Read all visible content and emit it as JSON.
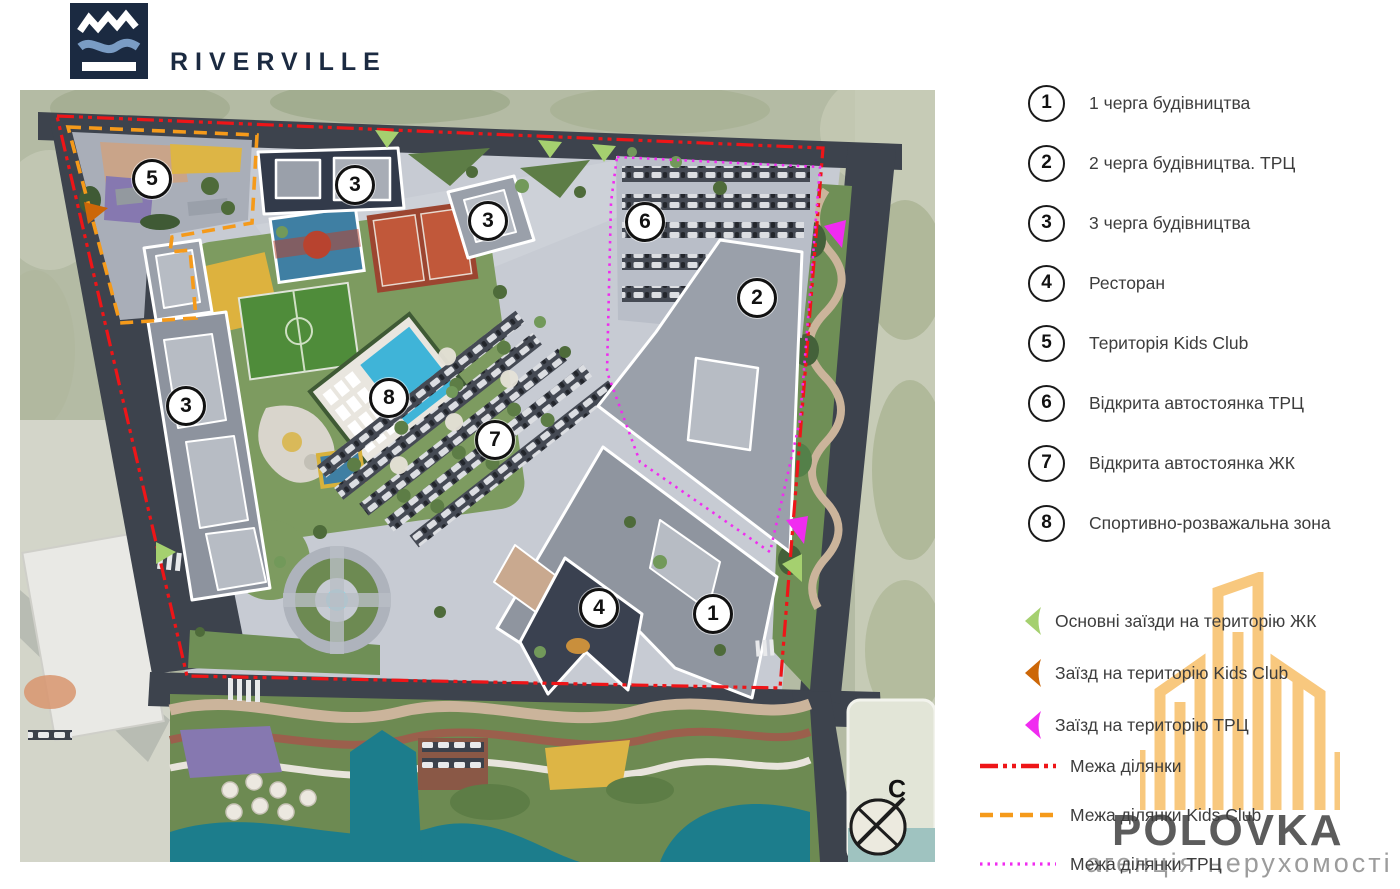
{
  "brand": {
    "name": "RIVERVILLE"
  },
  "map": {
    "compass_label": "С",
    "badges": [
      {
        "label": "5",
        "x": 132,
        "y": 89
      },
      {
        "label": "3",
        "x": 335,
        "y": 95
      },
      {
        "label": "3",
        "x": 468,
        "y": 131
      },
      {
        "label": "6",
        "x": 625,
        "y": 132
      },
      {
        "label": "2",
        "x": 737,
        "y": 208
      },
      {
        "label": "8",
        "x": 369,
        "y": 308
      },
      {
        "label": "3",
        "x": 166,
        "y": 316
      },
      {
        "label": "7",
        "x": 475,
        "y": 350
      },
      {
        "label": "4",
        "x": 579,
        "y": 518
      },
      {
        "label": "1",
        "x": 693,
        "y": 524
      }
    ]
  },
  "legend": {
    "items": [
      {
        "num": "1",
        "label": "1 черга будівництва"
      },
      {
        "num": "2",
        "label": "2 черга будівництва. ТРЦ"
      },
      {
        "num": "3",
        "label": "3 черга будівництва"
      },
      {
        "num": "4",
        "label": "Ресторан"
      },
      {
        "num": "5",
        "label": "Територія Kids Club"
      },
      {
        "num": "6",
        "label": "Відкрита автостоянка ТРЦ"
      },
      {
        "num": "7",
        "label": "Відкрита автостоянка ЖК"
      },
      {
        "num": "8",
        "label": "Спортивно-розважальна зона"
      }
    ],
    "entrances": [
      {
        "color": "#a5d06f",
        "label": "Основні заїзди на територію ЖК"
      },
      {
        "color": "#cc6708",
        "label": "Заїзд на територію Kids Club"
      },
      {
        "color": "#f02cf0",
        "label": "Заїзд на територію ТРЦ"
      }
    ],
    "boundaries": [
      {
        "style": "dashdot",
        "color": "#ee1518",
        "label": "Межа ділянки"
      },
      {
        "style": "dashed",
        "color": "#f59a1a",
        "label": "Межа ділянки Kids Club"
      },
      {
        "style": "dotted",
        "color": "#f02cf0",
        "label": "Межа ділянки ТРЦ"
      }
    ]
  },
  "watermark": {
    "title": "POLOVKA",
    "subtitle": "агенція нерухомості"
  },
  "colors": {
    "brand_navy": "#1b2a41",
    "site_red": "#ee1518",
    "kids_orange": "#f59a1a",
    "trc_magenta": "#f02cf0",
    "entry_green": "#a5d06f",
    "watermark_orange": "#f8c87e"
  }
}
